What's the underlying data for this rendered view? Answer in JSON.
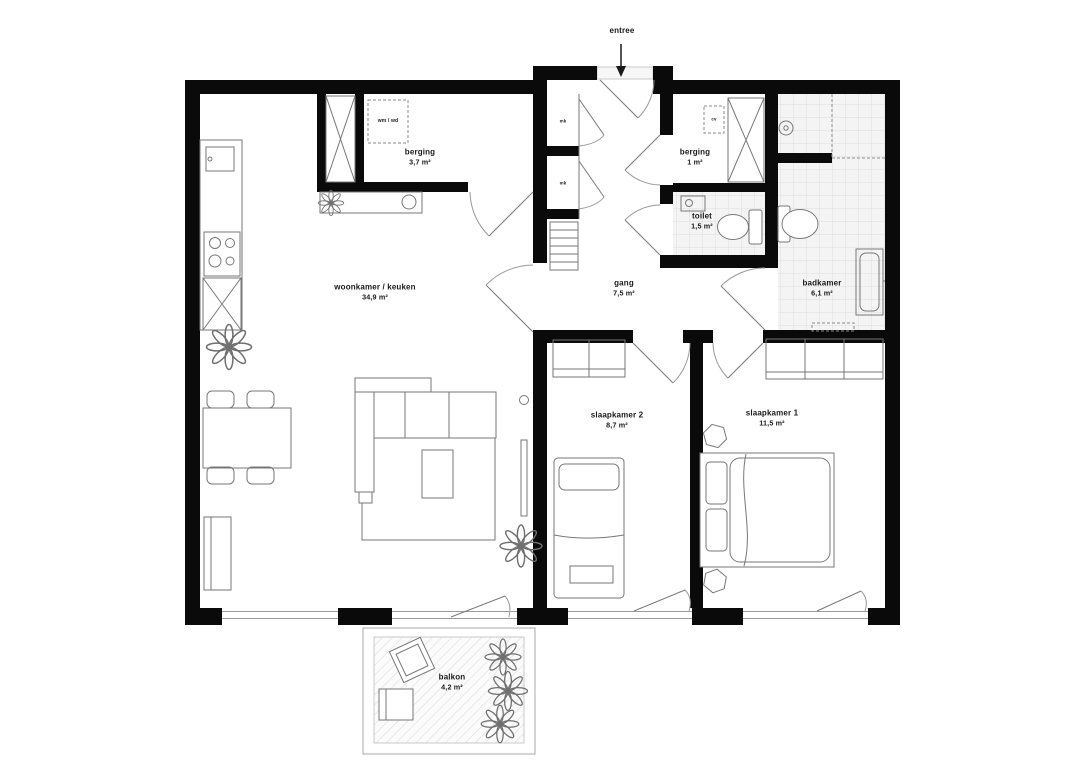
{
  "plan": {
    "entree_label": "entree",
    "rooms": {
      "woonkamer": {
        "name": "woonkamer / keuken",
        "area": "34,9 m²"
      },
      "berging_groot": {
        "name": "berging",
        "area": "3,7 m²"
      },
      "gang": {
        "name": "gang",
        "area": "7,5 m²"
      },
      "berging_klein": {
        "name": "berging",
        "area": "1 m²"
      },
      "toilet": {
        "name": "toilet",
        "area": "1,5 m²"
      },
      "badkamer": {
        "name": "badkamer",
        "area": "6,1 m²"
      },
      "slaapkamer2": {
        "name": "slaapkamer 2",
        "area": "8,7 m²"
      },
      "slaapkamer1": {
        "name": "slaapkamer 1",
        "area": "11,5 m²"
      },
      "balkon": {
        "name": "balkon",
        "area": "4,2 m²"
      }
    },
    "annotations": {
      "wasmachine": "wm / wd",
      "meterkast_1": "mk",
      "meterkast_2": "mk",
      "cv_ketel": "cv"
    }
  },
  "colors": {
    "wall-color": "#0a0a0a",
    "line-color": "#777777",
    "text-color": "#191919",
    "tile-line": "#dedede",
    "tile-bg": "#f4f4f4",
    "hatch-line": "#d8d8d8",
    "background": "#ffffff"
  }
}
